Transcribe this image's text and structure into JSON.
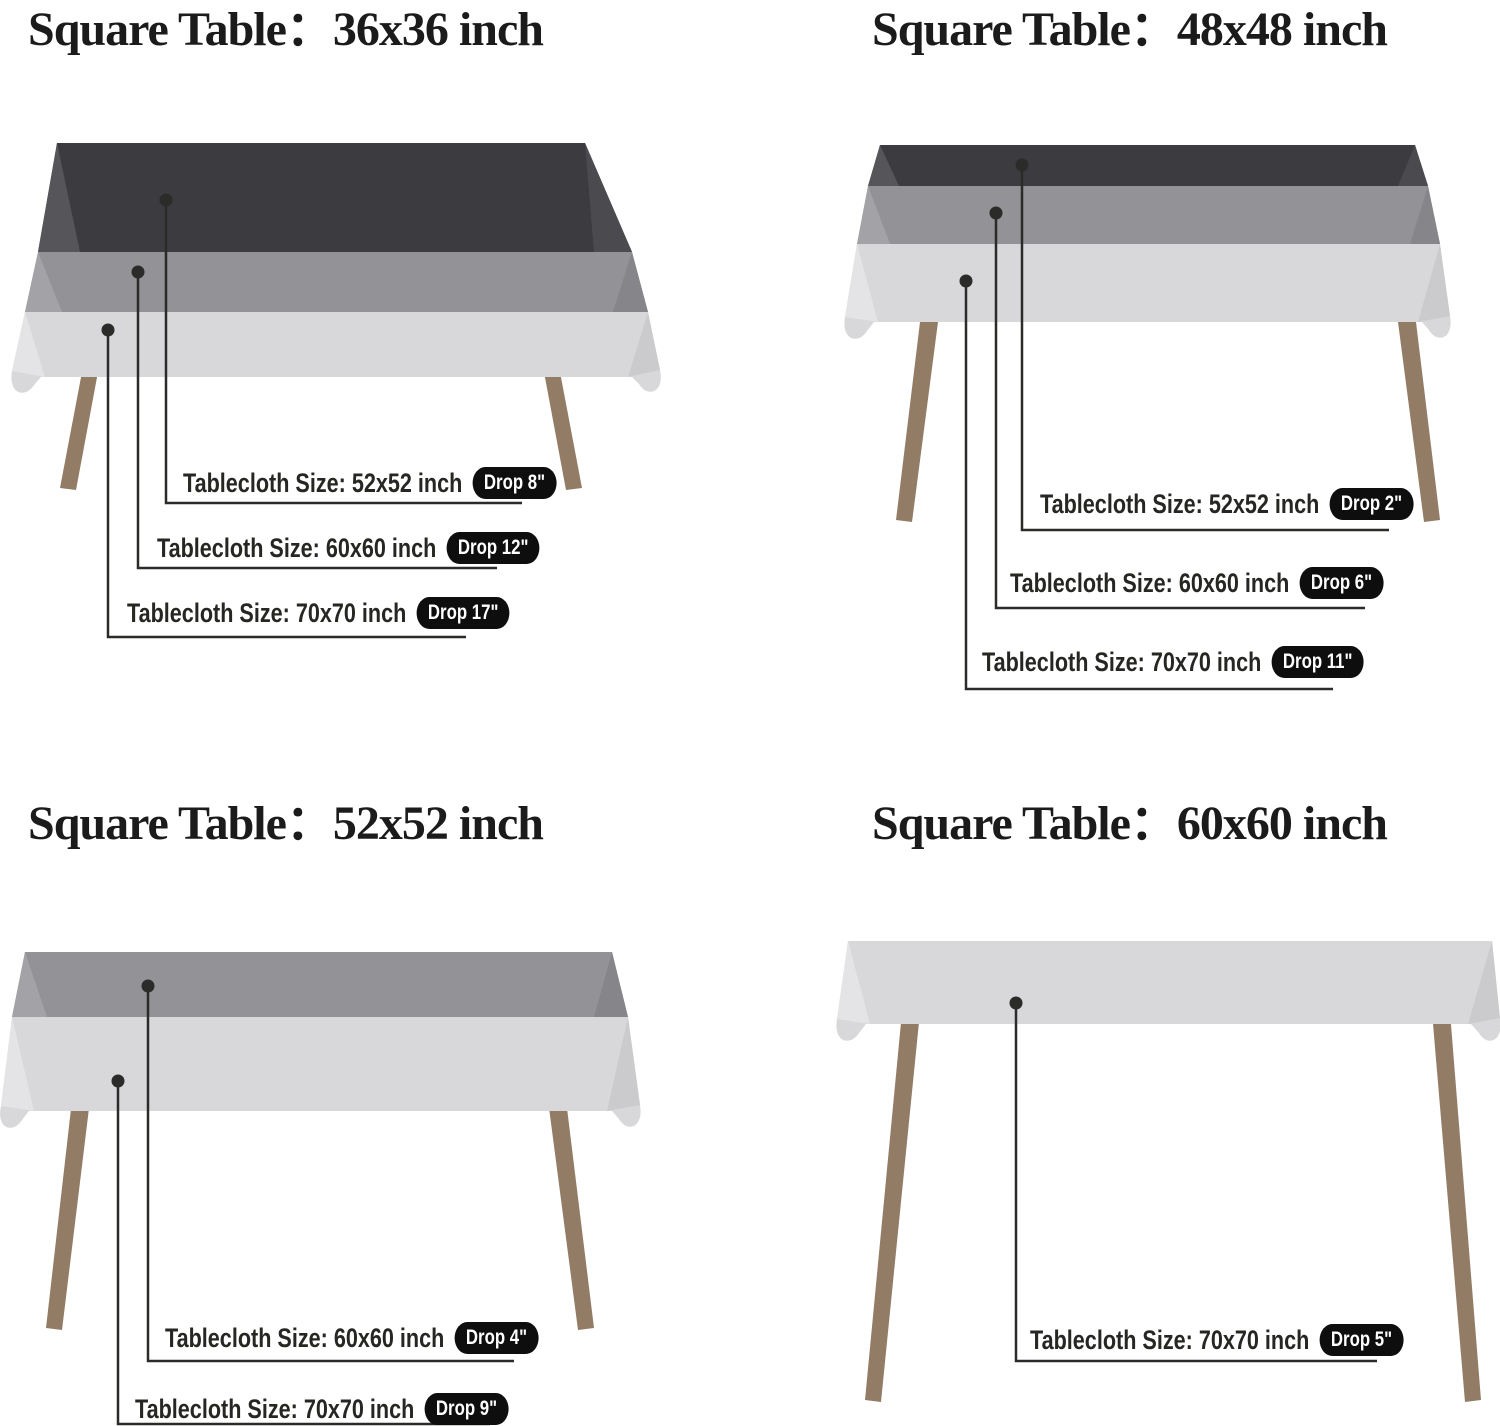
{
  "colors": {
    "background": "#ffffff",
    "cloth_dark": "#3c3c40",
    "cloth_mid": "#939397",
    "cloth_light": "#d8d8da",
    "leg": "#937c65",
    "line": "#2b2b29",
    "badge_bg": "#0e0e0e",
    "badge_text": "#ffffff",
    "title_text": "#1b1b1b"
  },
  "quadrants": [
    {
      "title": "Square Table：36x36 inch",
      "table_size": "36x36 inch",
      "labels": [
        {
          "size_label": "Tablecloth Size: 52x52 inch",
          "drop_badge": "Drop 8\""
        },
        {
          "size_label": "Tablecloth Size: 60x60 inch",
          "drop_badge": "Drop 12\""
        },
        {
          "size_label": "Tablecloth Size: 70x70 inch",
          "drop_badge": "Drop 17\""
        }
      ]
    },
    {
      "title": "Square Table：48x48 inch",
      "table_size": "48x48 inch",
      "labels": [
        {
          "size_label": "Tablecloth Size: 52x52 inch",
          "drop_badge": "Drop 2\""
        },
        {
          "size_label": "Tablecloth Size: 60x60 inch",
          "drop_badge": "Drop 6\""
        },
        {
          "size_label": "Tablecloth Size: 70x70 inch",
          "drop_badge": "Drop 11\""
        }
      ]
    },
    {
      "title": "Square Table：52x52 inch",
      "table_size": "52x52 inch",
      "labels": [
        {
          "size_label": "Tablecloth Size: 60x60 inch",
          "drop_badge": "Drop 4\""
        },
        {
          "size_label": "Tablecloth Size: 70x70 inch",
          "drop_badge": "Drop 9\""
        }
      ]
    },
    {
      "title": "Square Table：60x60 inch",
      "table_size": "60x60 inch",
      "labels": [
        {
          "size_label": "Tablecloth Size: 70x70 inch",
          "drop_badge": "Drop 5\""
        }
      ]
    }
  ]
}
